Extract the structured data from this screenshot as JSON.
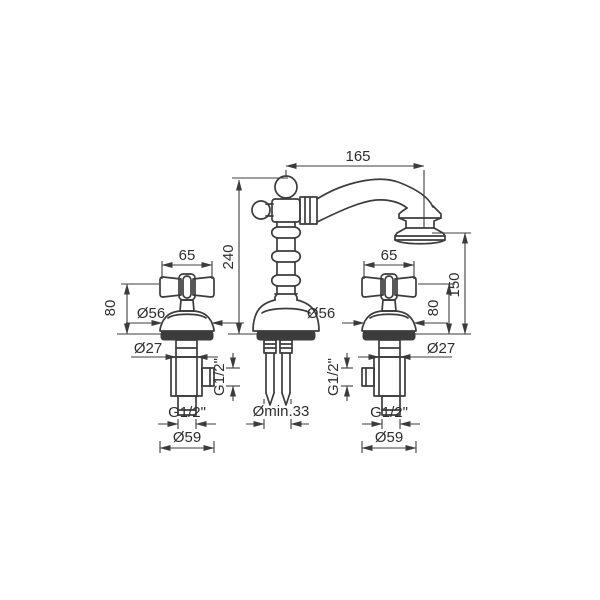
{
  "colors": {
    "line": "#3c3c3c",
    "text": "#2e2e2e",
    "background": "#ffffff"
  },
  "labels": {
    "spout_reach": "165",
    "total_height": "240",
    "spout_outlet_height": "150",
    "handle_width_left": "65",
    "handle_width_right": "65",
    "handle_height_left": "80",
    "handle_height_right": "80",
    "handle_base_diameter_left": "Ø56",
    "handle_base_diameter_right": "Ø56",
    "valve_stem_diameter_left": "Ø27",
    "valve_stem_diameter_right": "Ø27",
    "side_outlet_thread_left": "G1/2\"",
    "side_outlet_thread_right": "G1/2\"",
    "inlet_thread_left": "G1/2\"",
    "inlet_thread_right": "G1/2\"",
    "flange_diameter_left": "Ø59",
    "flange_diameter_right": "Ø59",
    "min_mounting_hole": "Ømin.33"
  }
}
